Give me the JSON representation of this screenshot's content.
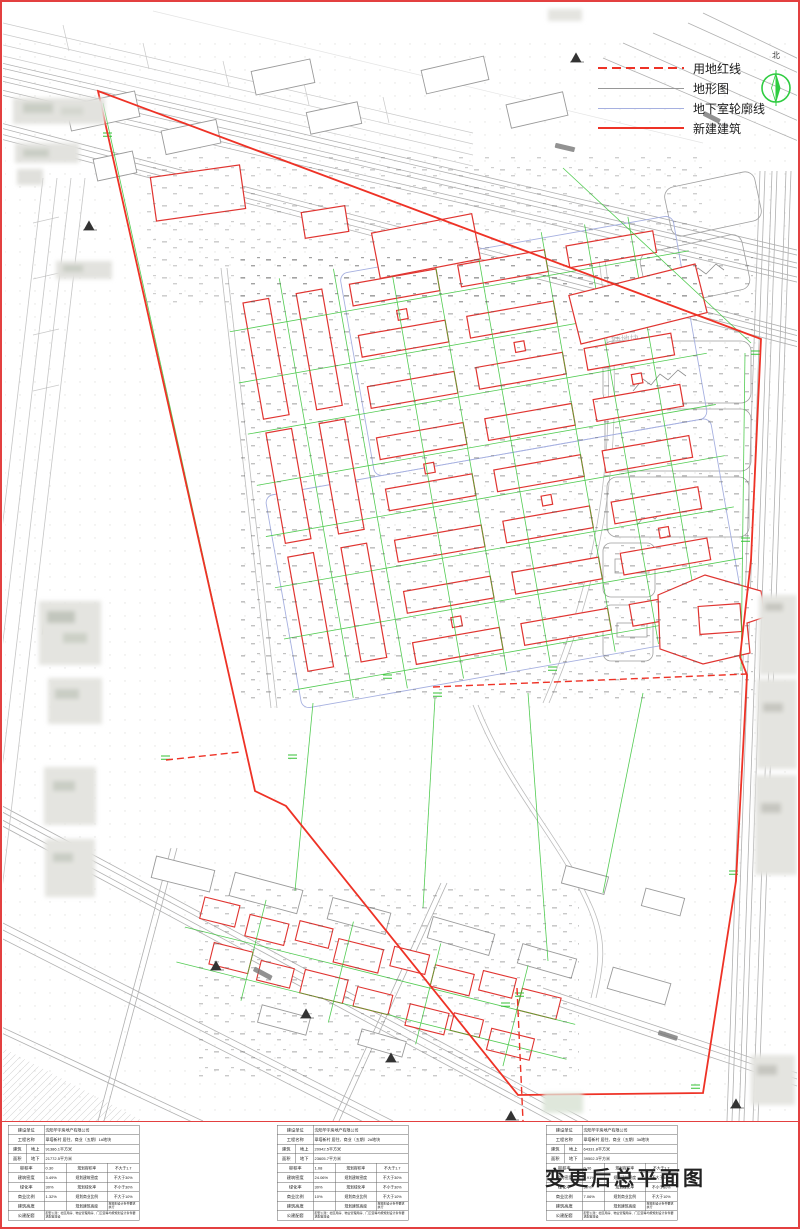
{
  "page": {
    "title": "变更后总平面图"
  },
  "north_label": "北",
  "legend": {
    "items": [
      {
        "label": "用地红线"
      },
      {
        "label": "地形图"
      },
      {
        "label": "地下室轮廓线"
      },
      {
        "label": "新建建筑"
      }
    ]
  },
  "map_labels": {
    "plot2": "2#地块"
  },
  "table_labels": {
    "unit": "建设单位",
    "project": "工程名称",
    "area_group": "建筑",
    "area_group2": "面积",
    "above": "地上",
    "below": "地下",
    "far": "容积率",
    "far_plan": "规划容积率",
    "density": "建筑密度",
    "density_plan": "规划建筑密度",
    "green": "绿化率",
    "green_plan": "规划绿化率",
    "commercial": "商业比例",
    "commercial_plan": "规划商业比例",
    "height": "建筑高度",
    "height_plan": "规划建筑高度",
    "public": "公建配套"
  },
  "tables": [
    {
      "unit": "沈阳华宇房地产有限公司",
      "project": "翠塔新村 居住、商业（五期）1#地块",
      "above": "91386.1平方米",
      "below": "21772.5平方米",
      "far": "0.30",
      "far_req": "不大于1.7",
      "density": "3.49%",
      "density_req": "不大于30%",
      "green": "30%",
      "green_req": "不小于30%",
      "commercial": "1.32%",
      "commercial_req": "不大于10%",
      "height": "",
      "height_req": "按规划设计条件要求执行",
      "public": "配套公建：社区用房、物业管理用房、门卫室等均按规划设计条件要求配置建设"
    },
    {
      "unit": "沈阳华宇房地产有限公司",
      "project": "翠塔新村 居住、商业（五期）2#地块",
      "above": "20942.5平方米",
      "below": "23605.7平方米",
      "far": "1.08",
      "far_req": "不大于1.7",
      "density": "24.06%",
      "density_req": "不大于30%",
      "green": "30%",
      "green_req": "不小于30%",
      "commercial": "10%",
      "commercial_req": "不大于10%",
      "height": "",
      "height_req": "按规划设计条件要求执行",
      "public": "配套公建：社区用房、物业管理用房、门卫室等均按规划设计条件要求配置建设"
    },
    {
      "unit": "沈阳华宇房地产有限公司",
      "project": "翠塔新村 居住、商业（五期）3#地块",
      "above": "64331.8平方米",
      "below": "39502.3平方米",
      "far": "0.36",
      "far_req": "不大于1.7",
      "density": "7.91%",
      "density_req": "不大于30%",
      "green": "30%",
      "green_req": "不小于30%",
      "commercial": "7.06%",
      "commercial_req": "不大于10%",
      "height": "",
      "height_req": "按规划设计条件要求执行",
      "public": "配套公建：社区用房、物业管理用房、门卫室等均按规划设计条件要求配置建设"
    }
  ]
}
